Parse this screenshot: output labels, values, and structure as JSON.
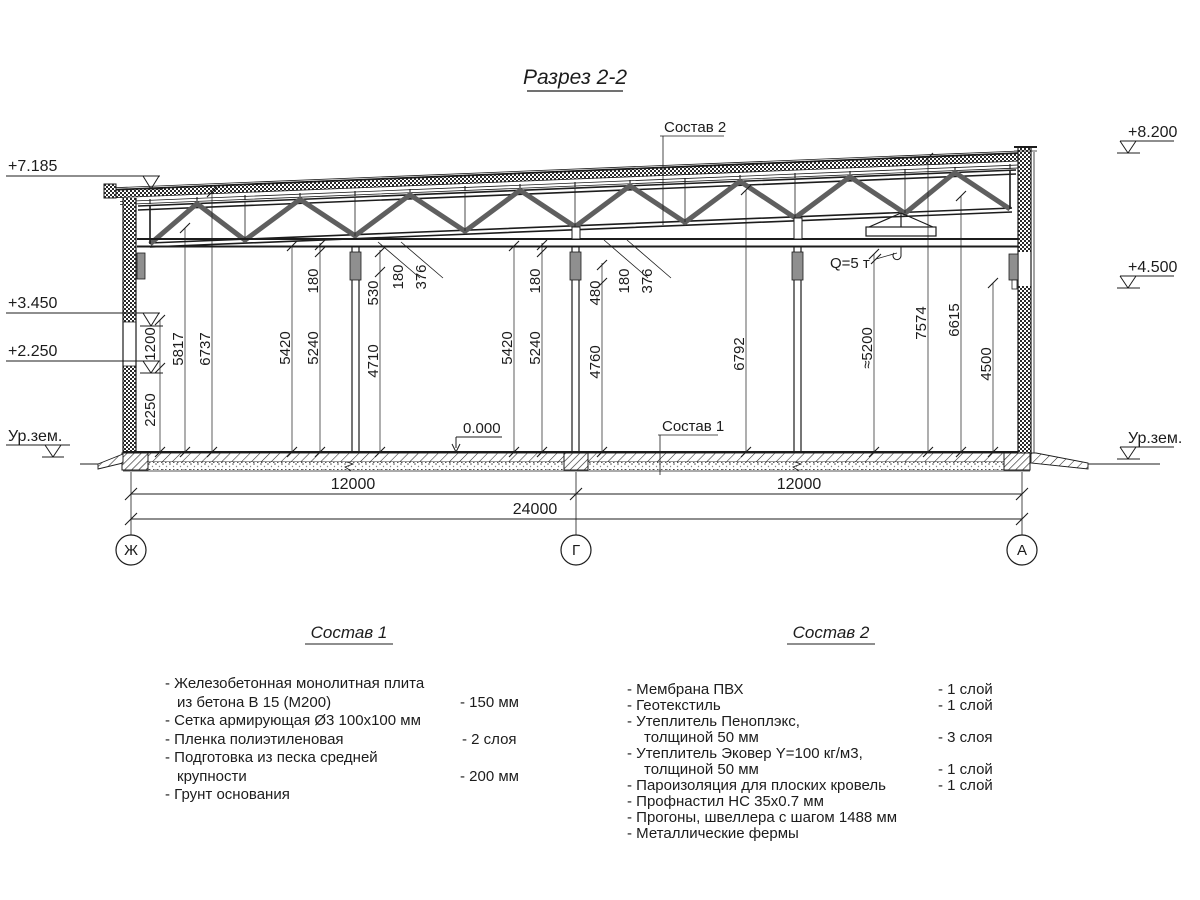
{
  "title": "Разрез 2-2",
  "callouts": {
    "roof_composition": "Состав 2",
    "floor_composition": "Состав 1",
    "zero_level": "0.000",
    "crane_capacity": "Q=5 т"
  },
  "ground": {
    "left": "Ур.зем.",
    "right": "Ур.зем."
  },
  "elevations": {
    "left": [
      {
        "label": "+7.185"
      },
      {
        "label": "+3.450"
      },
      {
        "label": "+2.250"
      }
    ],
    "right": [
      {
        "label": "+8.200"
      },
      {
        "label": "+4.500"
      }
    ]
  },
  "axes": [
    {
      "label": "Ж"
    },
    {
      "label": "Г"
    },
    {
      "label": "А"
    }
  ],
  "horizontal_dims": {
    "bay_left": "12000",
    "bay_right": "12000",
    "total": "24000"
  },
  "vertical_dims": [
    {
      "label": "2250"
    },
    {
      "label": "1200"
    },
    {
      "label": "5817"
    },
    {
      "label": "6737"
    },
    {
      "label": "5420"
    },
    {
      "label": "5240"
    },
    {
      "label": "180"
    },
    {
      "label": "530"
    },
    {
      "label": "4710"
    },
    {
      "label": "180"
    },
    {
      "label": "376"
    },
    {
      "label": "5420"
    },
    {
      "label": "5240"
    },
    {
      "label": "180"
    },
    {
      "label": "480"
    },
    {
      "label": "4760"
    },
    {
      "label": "180"
    },
    {
      "label": "376"
    },
    {
      "label": "6792"
    },
    {
      "label": "≈5200"
    },
    {
      "label": "7574"
    },
    {
      "label": "6615"
    },
    {
      "label": "4500"
    }
  ],
  "composition1": {
    "heading": "Состав 1",
    "rows": [
      {
        "text": "- Железобетонная  монолитная плита",
        "value": ""
      },
      {
        "text": "из бетона В 15 (М200)",
        "value": "- 150 мм"
      },
      {
        "text": "- Сетка армирующая Ø3 100х100 мм",
        "value": ""
      },
      {
        "text": "- Пленка полиэтиленовая",
        "value": "- 2 слоя"
      },
      {
        "text": "- Подготовка из песка средней",
        "value": ""
      },
      {
        "text": "крупности",
        "value": "- 200 мм"
      },
      {
        "text": "- Грунт основания",
        "value": ""
      }
    ]
  },
  "composition2": {
    "heading": "Состав 2",
    "rows": [
      {
        "text": "- Мембрана ПВХ",
        "value": "- 1 слой"
      },
      {
        "text": "- Геотекстиль",
        "value": "- 1 слой"
      },
      {
        "text": "- Утеплитель Пеноплэкс,",
        "value": ""
      },
      {
        "text": "толщиной 50 мм",
        "value": "- 3 слоя"
      },
      {
        "text": "- Утеплитель Эковер Y=100 кг/м3,",
        "value": ""
      },
      {
        "text": "толщиной 50 мм",
        "value": "- 1 слой"
      },
      {
        "text": "- Пароизоляция для плоских кровель",
        "value": "- 1 слой"
      },
      {
        "text": "- Профнастил НС 35х0.7 мм",
        "value": ""
      },
      {
        "text": "- Прогоны, швеллера с шагом 1488 мм",
        "value": ""
      },
      {
        "text": "- Металлические фермы",
        "value": ""
      }
    ]
  }
}
